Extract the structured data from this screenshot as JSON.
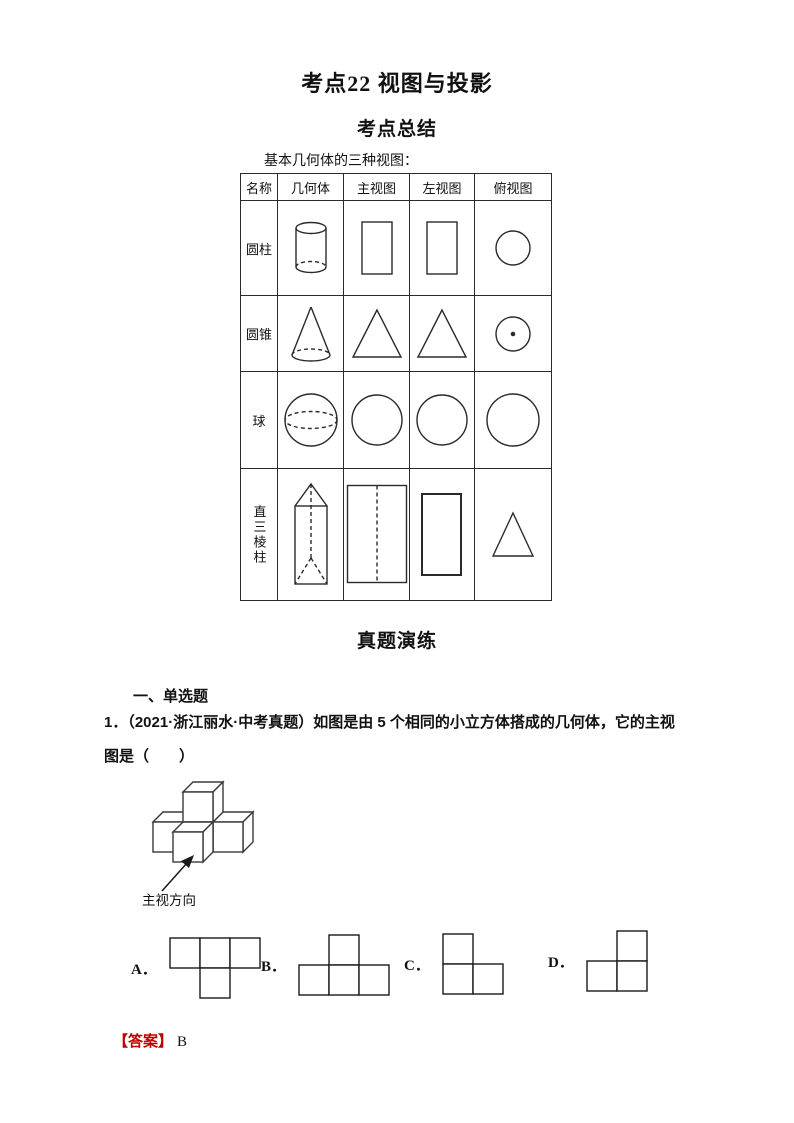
{
  "page": {
    "title": "考点22 视图与投影",
    "subtitle": "考点总结"
  },
  "summary_table": {
    "caption": "基本几何体的三种视图：",
    "headers": [
      "名称",
      "几何体",
      "主视图",
      "左视图",
      "俯视图"
    ],
    "rows": [
      {
        "name": "圆柱"
      },
      {
        "name": "圆锥"
      },
      {
        "name": "球"
      },
      {
        "name": "直三棱柱"
      }
    ]
  },
  "exercise": {
    "section_title": "真题演练",
    "subsection": "一、单选题",
    "question1": {
      "number": "1．",
      "source": "（2021·浙江丽水·中考真题）",
      "text_line1": "如图是由 5 个相同的小立方体搭成的几何体，它的主视",
      "text_line2": "图是（　　）",
      "figure_label": "主视方向",
      "options": [
        {
          "label": "A．",
          "cols": 3,
          "cells": [
            [
              0,
              0
            ],
            [
              1,
              0
            ],
            [
              2,
              0
            ],
            [
              1,
              1
            ]
          ]
        },
        {
          "label": "B．",
          "cols": 3,
          "cells": [
            [
              1,
              0
            ],
            [
              0,
              1
            ],
            [
              1,
              1
            ],
            [
              2,
              1
            ]
          ]
        },
        {
          "label": "C．",
          "cols": 2,
          "cells": [
            [
              0,
              0
            ],
            [
              0,
              1
            ],
            [
              1,
              1
            ]
          ]
        },
        {
          "label": "D．",
          "cols": 2,
          "cells": [
            [
              1,
              0
            ],
            [
              0,
              1
            ],
            [
              1,
              1
            ]
          ]
        }
      ],
      "answer_label": "【答案】",
      "answer": "B"
    }
  },
  "colors": {
    "answer_red": "#c00000",
    "text": "#111111"
  }
}
